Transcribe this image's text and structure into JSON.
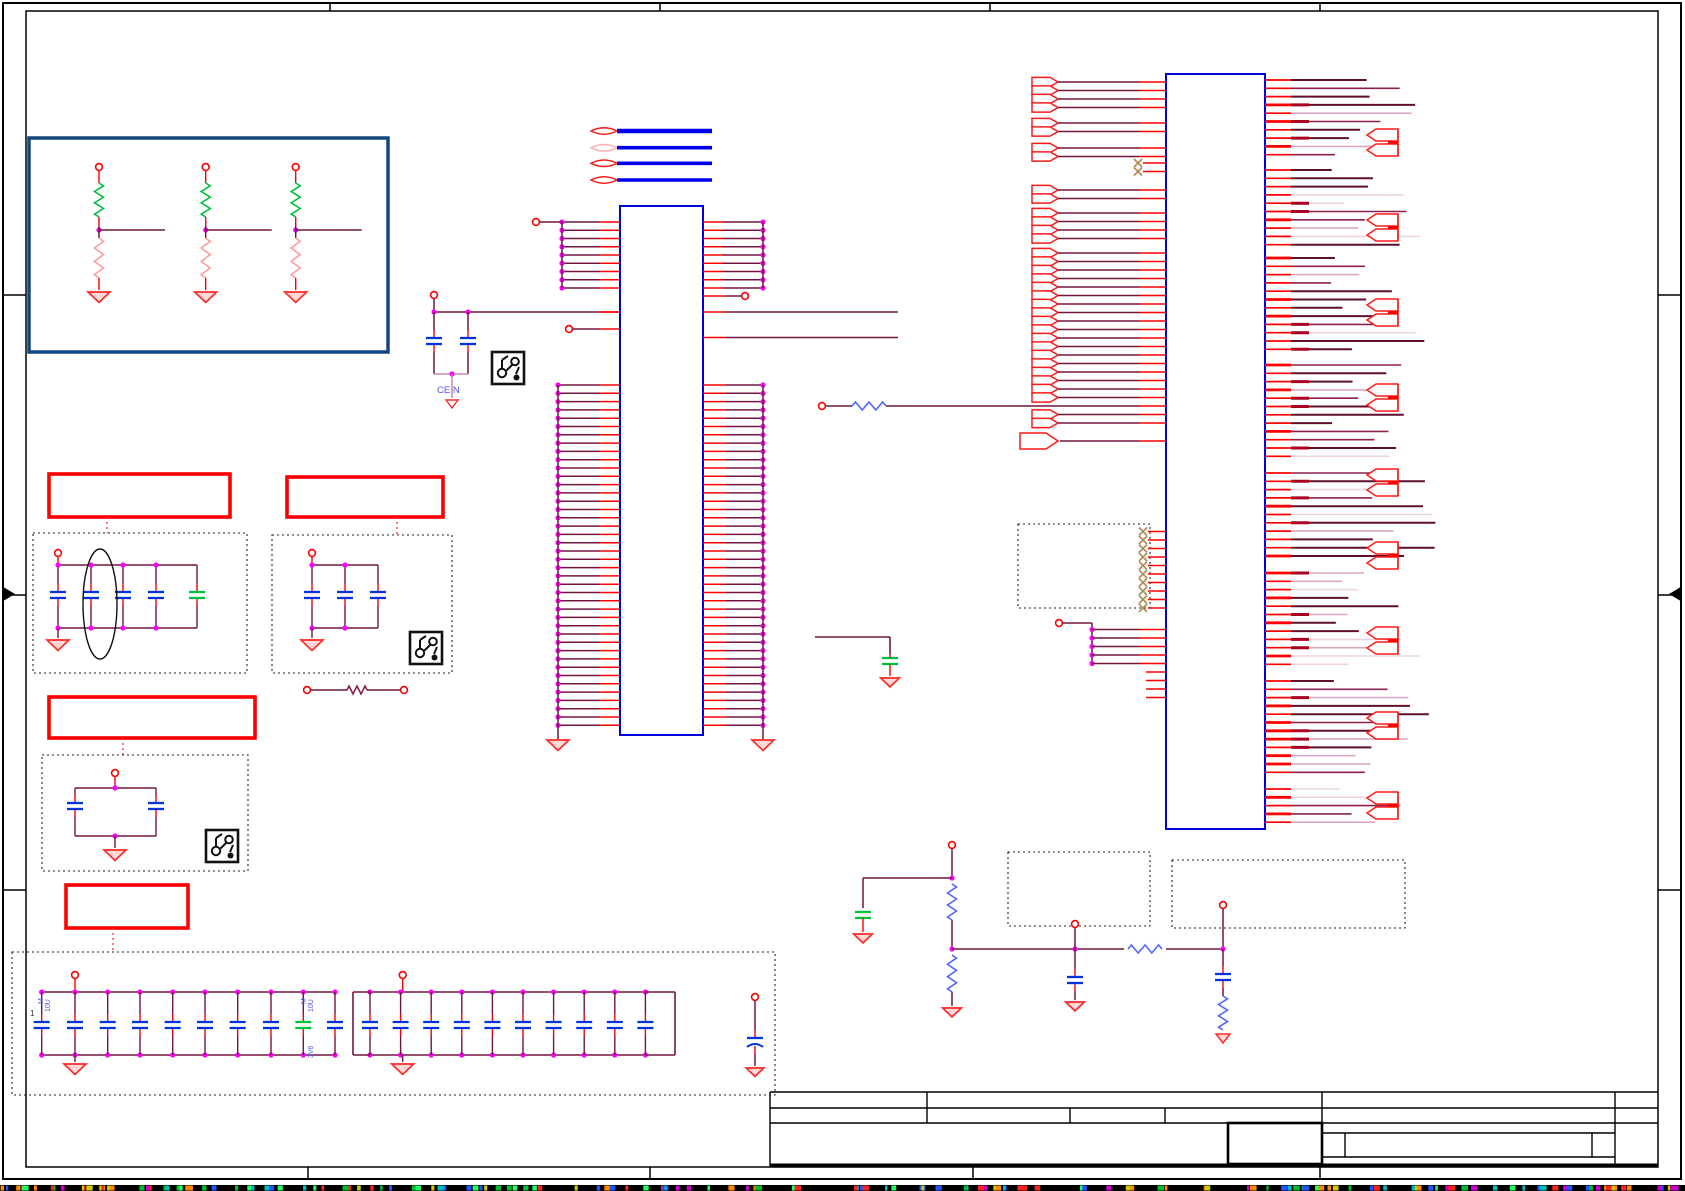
{
  "app": {
    "type": "schematic-viewer",
    "sheet_background": "#ffffff"
  },
  "labels": {
    "cen_net": "CE  N",
    "cap_value": "10U",
    "cap_tolerance": "M",
    "cap_voltage": "3V6",
    "cap_pin1": "1"
  },
  "colors": {
    "wire": "#71163f",
    "stub": "#ff0000",
    "junction": "#ff00ff",
    "ic_outline": "#0000dd",
    "bus_blue": "#0000ee",
    "resistor_green": "#00c13d",
    "resistor_pink": "#ff9e9e",
    "resistor_blue": "#5566ff",
    "cap_blue": "#0033dd",
    "cap_green": "#00c13d",
    "ground_stroke": "#ff2a2a",
    "ground_fill": "#ffd8d8",
    "port_red": "#ff1a1a",
    "port_light": "#ffb0b0",
    "net_dark": "#5f0f2e",
    "net_mid": "#8a2050",
    "net_pink": "#d9a8c4",
    "net_pale": "#ecd4e2",
    "nc_x": "#b08a50",
    "frame": "#000000",
    "red_box": "#ff0000",
    "blue_box": "#15467e",
    "dotted": "#222222",
    "label_blue": "#5555e8",
    "text_dark": "#333333",
    "strip_base": "#000000",
    "strip_palette": [
      "#00bb33",
      "#cc00cc",
      "#00bbbb",
      "#cccc00",
      "#2255ff",
      "#ff2222",
      "#ff8800",
      "#22ff66"
    ]
  },
  "counts": {
    "pull_networks": 3,
    "offpage_connectors": 4,
    "center_ic": {
      "top_pin_rows": 9,
      "bottom_pin_rows": 42
    },
    "right_ic": {
      "no_connect_rows": 10,
      "top_no_connect_rows": 2,
      "bus_pin_rows": 5,
      "plain_stub_rows": 4,
      "right_arrow_pairs": 9
    },
    "right_ic_flag_bands": [
      {
        "y": 82,
        "n": 4
      },
      {
        "y": 123,
        "n": 2
      },
      {
        "y": 148,
        "n": 2
      },
      {
        "y": 190,
        "n": 2
      },
      {
        "y": 213,
        "n": 4
      },
      {
        "y": 253,
        "n": 18
      },
      {
        "y": 414.5,
        "n": 2
      }
    ],
    "decoupling": {
      "box1_caps": 5,
      "box2_caps": 3,
      "box3_caps": 2
    },
    "cap_banks": {
      "bank1_caps": 10,
      "bank2_caps": 10
    },
    "pcb_icons": 3,
    "red_annotation_boxes": 4
  }
}
